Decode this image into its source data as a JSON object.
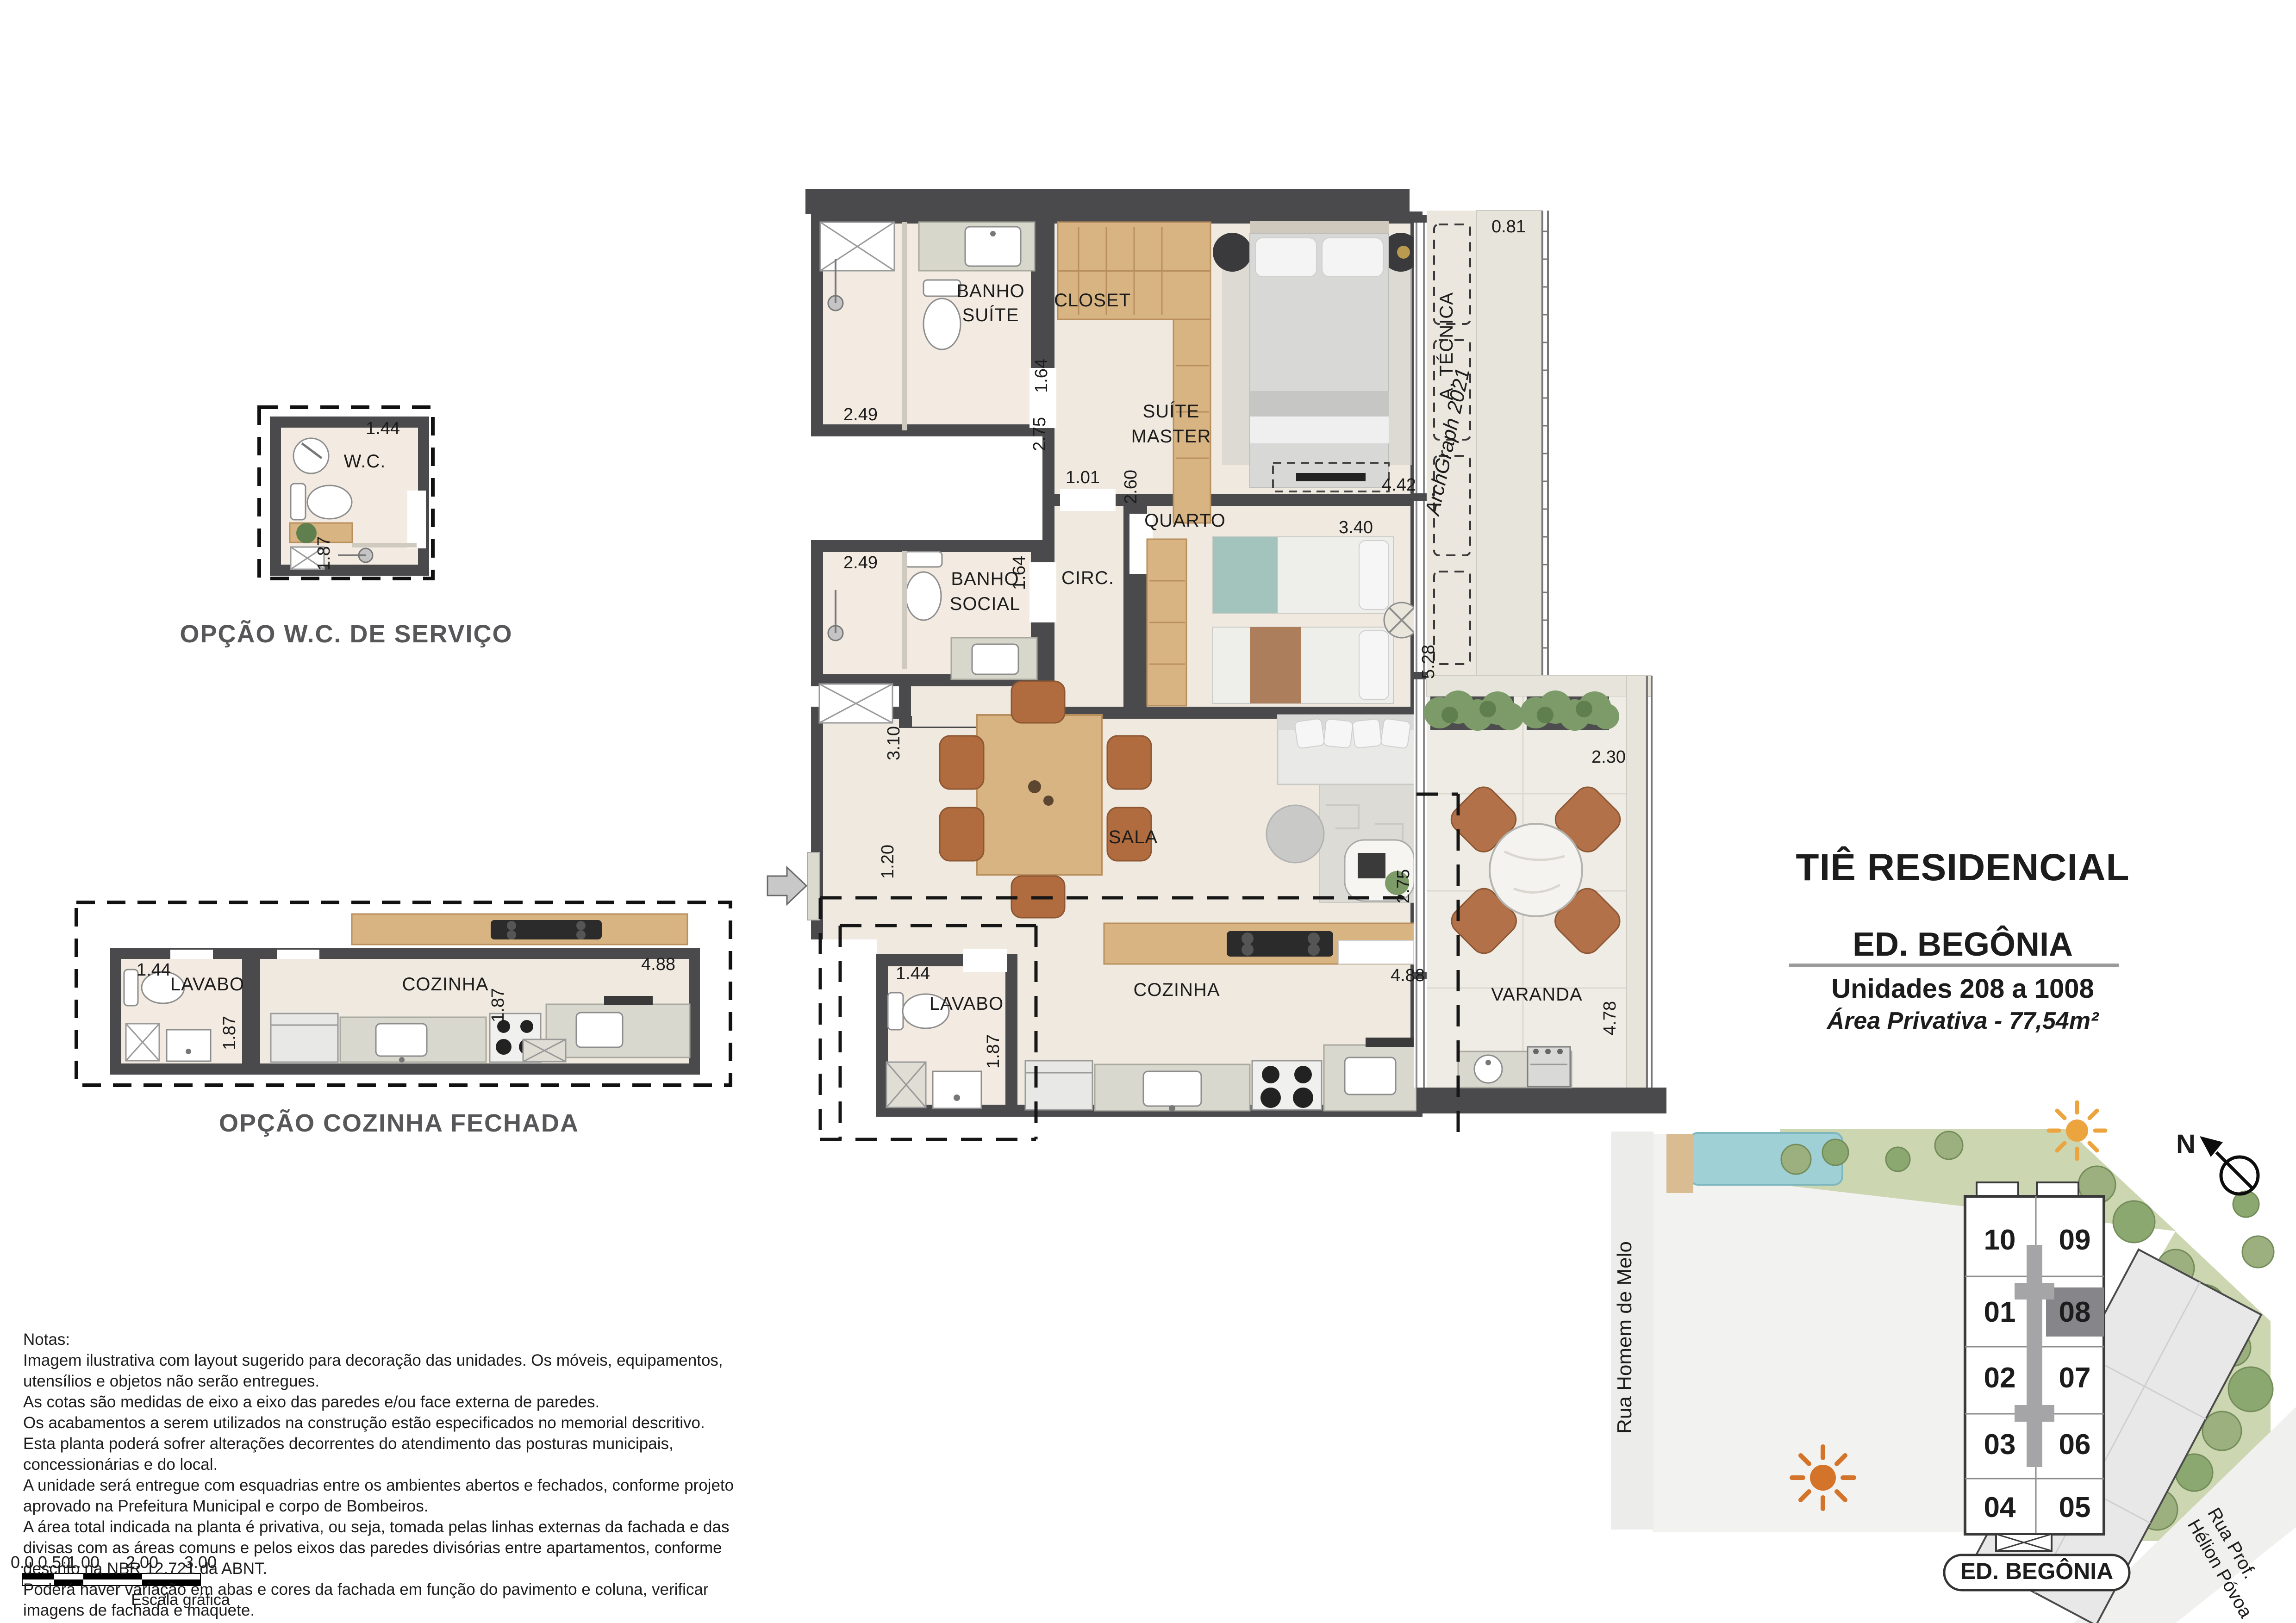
{
  "panel": {
    "project": "TIÊ RESIDENCIAL",
    "building": "ED. BEGÔNIA",
    "units": "Unidades 208 a 1008",
    "area": "Área Privativa - 77,54m²"
  },
  "options": {
    "wc": "OPÇÃO W.C. DE SERVIÇO",
    "kitchen": "OPÇÃO COZINHA FECHADA"
  },
  "rooms": {
    "banho_suite_1": "BANHO",
    "banho_suite_2": "SUÍTE",
    "closet": "CLOSET",
    "suite_1": "SUÍTE",
    "suite_2": "MASTER",
    "quarto": "QUARTO",
    "circ": "CIRC.",
    "banho_social_1": "BANHO",
    "banho_social_2": "SOCIAL",
    "sala": "SALA",
    "cozinha": "COZINHA",
    "lavabo": "LAVABO",
    "varanda": "VARANDA",
    "atecnica": "A. TÉCNICA",
    "wc": "W.C.",
    "opt_lavabo": "LAVABO",
    "opt_cozinha": "COZINHA"
  },
  "dims": {
    "banho_suite_w": "2.49",
    "banho_suite_d": "1.64",
    "social_w": "2.49",
    "social_d": "1.64",
    "closet_d": "2.75",
    "hall": "1.01",
    "quarto_d": "2.60",
    "quarto_w": "3.40",
    "suite_w": "4.42",
    "atec_top": "0.81",
    "atec_h": "5.28",
    "nook": "3.10",
    "entry": "1.20",
    "sala_d": "2.75",
    "cozinha_w": "4.88",
    "lavabo_w": "1.44",
    "lavabo_d": "1.87",
    "varanda_w": "2.30",
    "varanda_d": "4.78",
    "wc_w": "1.44",
    "wc_d": "1.87",
    "opt_lav_w": "1.44",
    "opt_lav_d": "1.87",
    "opt_koz_w": "4.88",
    "opt_koz_d": "1.87"
  },
  "notes": {
    "title": "Notas:",
    "lines": [
      "Imagem ilustrativa com layout sugerido para decoração das unidades. Os móveis, equipamentos,",
      "utensílios e objetos não serão entregues.",
      "As cotas são medidas de eixo a eixo das paredes e/ou face externa de paredes.",
      "Os acabamentos a serem utilizados na construção estão especificados no memorial descritivo.",
      "Esta planta poderá sofrer alterações decorrentes do atendimento das posturas municipais,",
      "concessionárias e do local.",
      "A unidade será entregue com esquadrias entre os ambientes abertos e fechados, conforme projeto",
      "aprovado na Prefeitura Municipal e corpo de Bombeiros.",
      "A área total indicada na planta é privativa, ou seja, tomada pelas linhas externas da fachada e das",
      "divisas com as áreas comuns e pelos eixos das paredes divisórias entre apartamentos, conforme",
      "descrito na NBR 12.721 da ABNT.",
      "Poderá haver variação em abas e cores da fachada em função do pavimento e coluna, verificar",
      "imagens de fachada e maquete."
    ]
  },
  "scalebar": {
    "ticks": [
      "0.0",
      "0.50",
      "1.00",
      "2.00",
      "3.00"
    ],
    "label": "Escala gráfica"
  },
  "siteplan": {
    "street_left": "Rua Homem de Melo",
    "street_right_1": "Rua Prof.",
    "street_right_2": "Hélion Póvoa",
    "pill": "ED. BEGÔNIA",
    "north": "N",
    "units_left": [
      "10",
      "01",
      "02",
      "03",
      "04"
    ],
    "units_right": [
      "09",
      "08",
      "07",
      "06",
      "05"
    ]
  },
  "watermark": "ArchGraph 2021",
  "colors": {
    "wall": "#4a4a4d",
    "floor": "#efe9e0",
    "bath_floor": "#f3ebe1",
    "wood": "#d9b483",
    "granite": "#d8d8ce",
    "accent_teal": "#a3c4bc",
    "accent_brown": "#ad7e5c",
    "chair_brown": "#b06b3e",
    "plant_green": "#7d9b68",
    "grass": "#ccd6b0",
    "sun_top": "#eca43e",
    "sun_bottom": "#d4732a",
    "highlight_unit_bg": "#85858a"
  }
}
